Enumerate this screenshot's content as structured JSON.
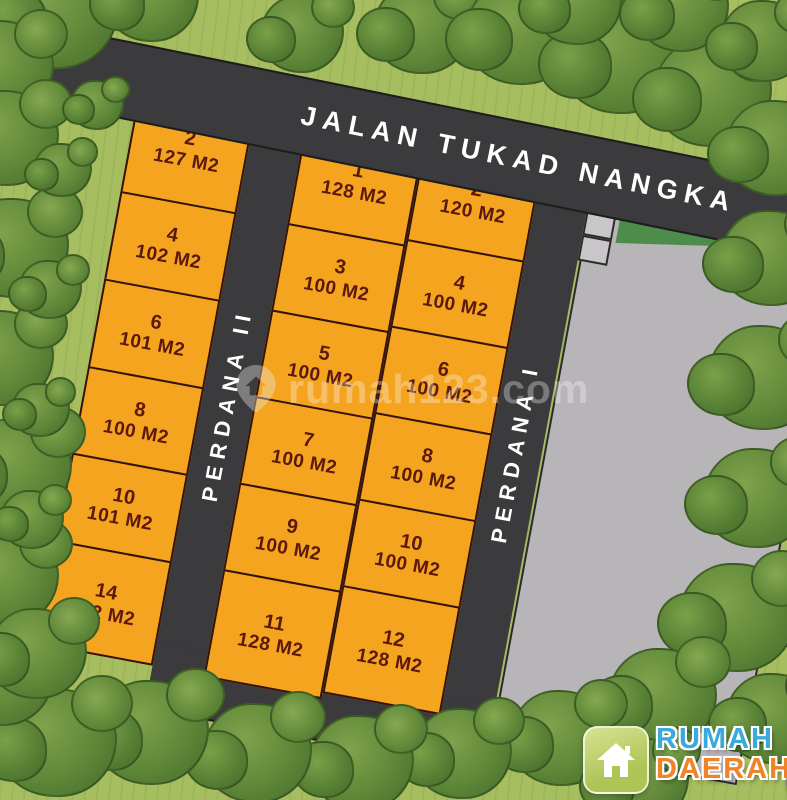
{
  "map": {
    "roads": {
      "top": "JALAN TUKAD NANGKA",
      "left_vertical": "PERDANA II",
      "right_vertical": "PERDANA I"
    },
    "columns": [
      {
        "id": "left",
        "plots": [
          {
            "no": "2",
            "area": "127 M2"
          },
          {
            "no": "4",
            "area": "102 M2"
          },
          {
            "no": "6",
            "area": "101 M2"
          },
          {
            "no": "8",
            "area": "100 M2"
          },
          {
            "no": "10",
            "area": "101 M2"
          },
          {
            "no": "14",
            "area": "122 M2"
          }
        ]
      },
      {
        "id": "mid-left",
        "plots": [
          {
            "no": "1",
            "area": "128 M2"
          },
          {
            "no": "3",
            "area": "100 M2"
          },
          {
            "no": "5",
            "area": "100 M2"
          },
          {
            "no": "7",
            "area": "100 M2"
          },
          {
            "no": "9",
            "area": "100 M2"
          },
          {
            "no": "11",
            "area": "128 M2"
          }
        ]
      },
      {
        "id": "mid-right",
        "plots": [
          {
            "no": "2",
            "area": "120 M2"
          },
          {
            "no": "4",
            "area": "100 M2"
          },
          {
            "no": "6",
            "area": "100 M2"
          },
          {
            "no": "8",
            "area": "100 M2"
          },
          {
            "no": "10",
            "area": "100 M2"
          },
          {
            "no": "12",
            "area": "128 M2"
          }
        ]
      }
    ]
  },
  "watermark": {
    "text": "rumah123.com"
  },
  "logo": {
    "line1": "RUMAH",
    "line2": "DAERAH",
    "tld": ".COM"
  },
  "colors": {
    "grass": "#A6BD60",
    "tree_green": "#5E8738",
    "road": "#3B3A3C",
    "plot_fill": "#F5A41F",
    "plot_text": "#5B190C",
    "buffer_green": "#2C4B2F",
    "open_area_gray": "#B8B5B8",
    "brand_blue": "#3AA9DC",
    "brand_orange": "#EF832A"
  }
}
